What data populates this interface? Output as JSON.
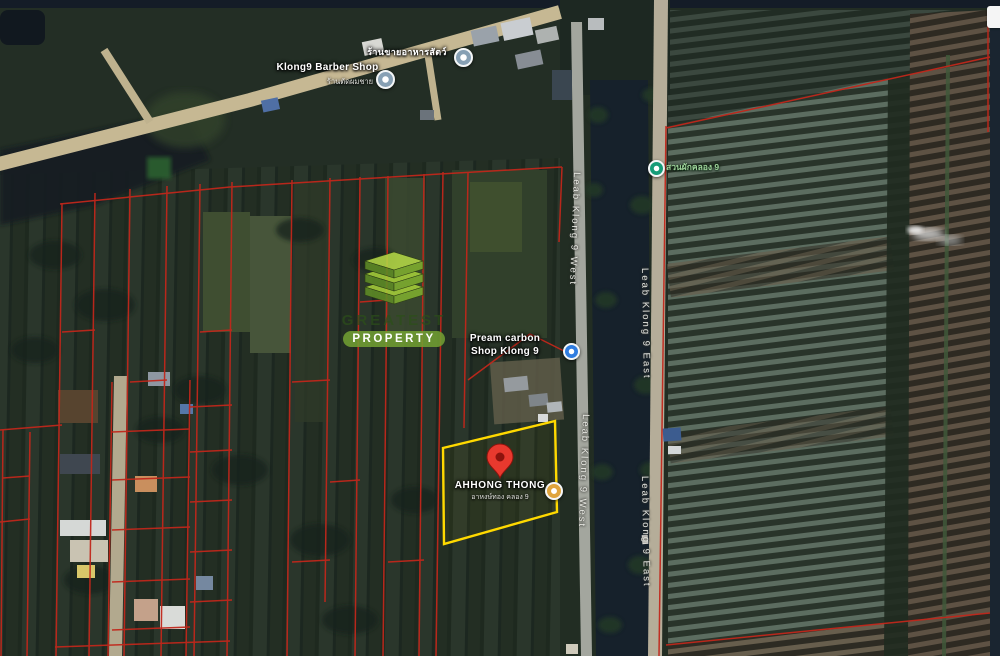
{
  "labels": {
    "barber_title": "Klong9 Barber Shop",
    "barber_sub": "ร้านตัดผมชาย",
    "top_shop": "ร้านขายอาหารสัตว์",
    "pream_line1": "Pream carbon",
    "pream_line2": "Shop Klong 9",
    "garden": "สวนผักคลอง 9",
    "ahhong_title": "AHHONG THONG",
    "ahhong_sub": "อาหงษ์ทอง คลอง 9",
    "road_west": "Leab Klong 9 West",
    "road_east": "Leab Klong 9 East"
  },
  "watermark": {
    "line1": "GREATEST",
    "line2": "PROPERTY"
  },
  "icons": {
    "barber": "poi-circle",
    "top_shop": "poi-circle",
    "pream": "shopping-poi",
    "garden": "garden-poi",
    "ahhong": "restaurant-poi",
    "pin": "map-pin"
  },
  "colors": {
    "cadastral_line": "#c1271b",
    "parcel_outline": "#ffd900",
    "pin_red": "#e8392e",
    "poi_blue": "#2f7de0",
    "poi_teal": "#169c78",
    "poi_amber": "#dfa43c",
    "logo_green": "#719e32",
    "road_tan": "#c6b893",
    "canal_dark": "#16212b"
  }
}
